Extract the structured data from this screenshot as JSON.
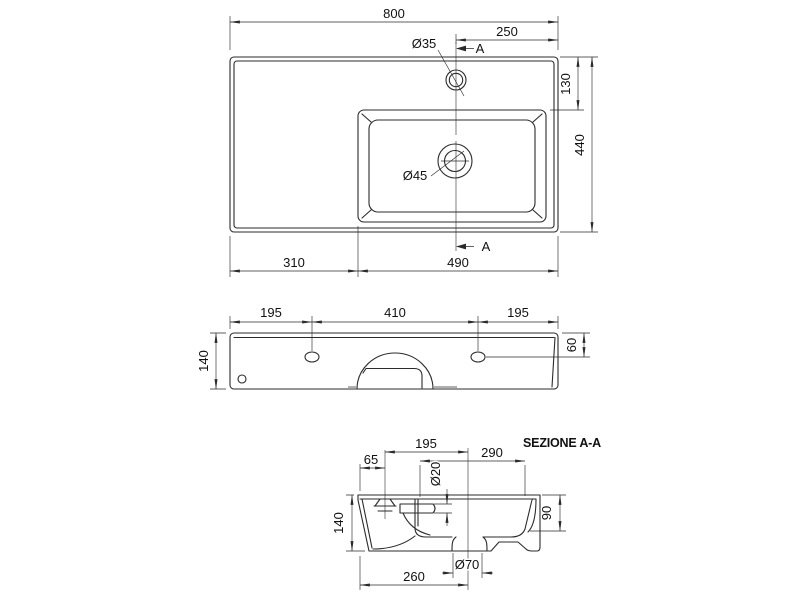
{
  "app": {
    "background": "#ffffff",
    "line_color": "#2b2b2b",
    "text_color": "#111111"
  },
  "section_title": "SEZIONE A-A",
  "top_view": {
    "overall_width": "800",
    "faucet_offset": "250",
    "faucet_dia": "Ø35",
    "section_marker": "A",
    "back_strip": "130",
    "overall_depth": "440",
    "drain_dia": "Ø45",
    "left_ledge": "310",
    "basin_zone": "490"
  },
  "front_view": {
    "left_hole_offset": "195",
    "hole_spacing": "410",
    "right_hole_offset": "195",
    "height": "140",
    "hole_drop": "60"
  },
  "section_view": {
    "faucet_back_gap": "65",
    "faucet_to_drain": "195",
    "bowl_span": "290",
    "overflow_dia": "Ø20",
    "height": "140",
    "bowl_depth": "90",
    "drain_boss_dia": "Ø70",
    "back_to_drain": "260"
  }
}
